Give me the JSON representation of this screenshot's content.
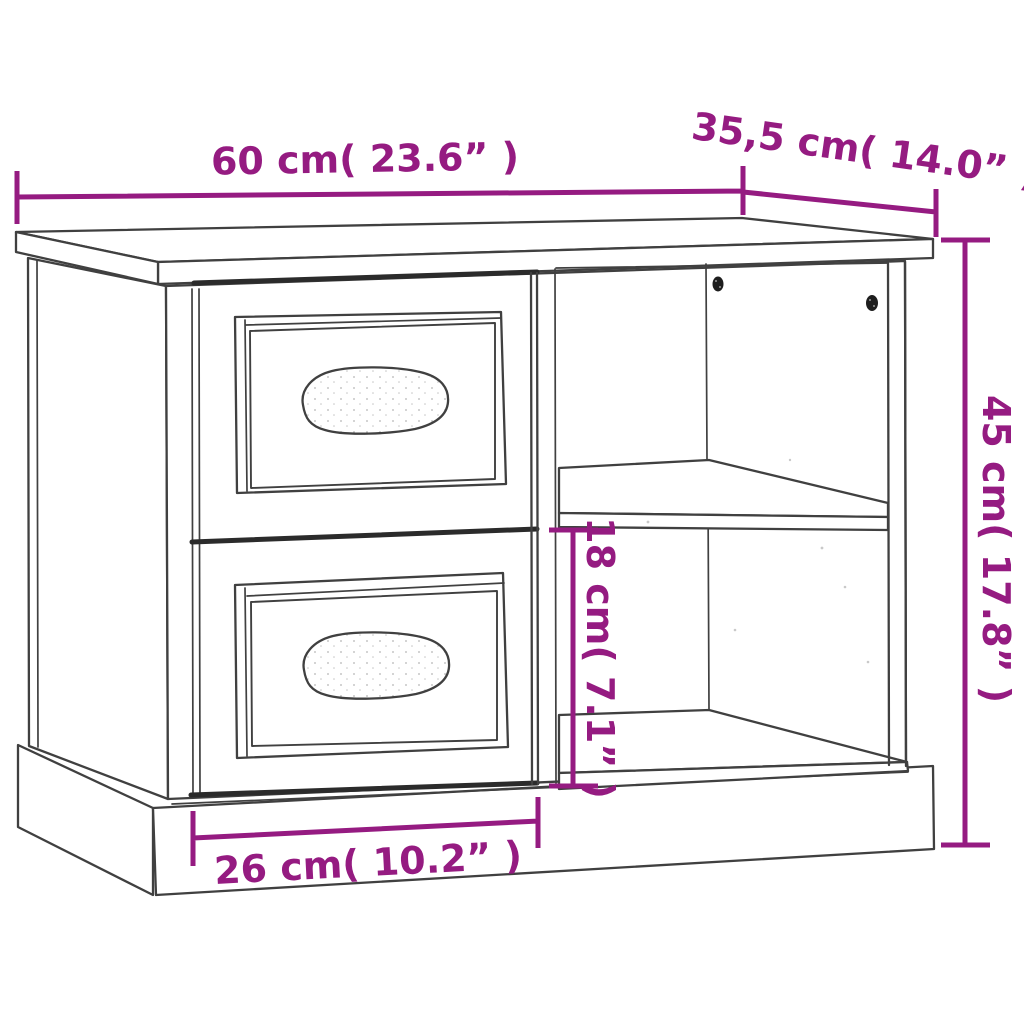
{
  "diagram": {
    "subject": "Bedside cabinet line drawing with two drawers, shell handles, open shelf compartments and plinth base",
    "style": "technical product dimension diagram"
  },
  "colors": {
    "purple": "#951b81",
    "ink": "#404040",
    "ink-strong": "#2b2b2b",
    "bg": "#ffffff"
  },
  "dimensions": {
    "width": {
      "metric": "60 cm",
      "imperial": "23.6”",
      "label": "60 cm( 23.6” )"
    },
    "depth": {
      "metric": "35,5 cm",
      "imperial": "14.0”",
      "label": "35,5 cm( 14.0” )"
    },
    "height": {
      "metric": "45 cm",
      "imperial": "17.8”",
      "label": "45 cm( 17.8” )"
    },
    "compartment_height": {
      "metric": "18 cm",
      "imperial": "7.1”",
      "label": "18 cm( 7.1” )"
    },
    "drawer_width": {
      "metric": "26 cm",
      "imperial": "10.2”",
      "label": "26 cm( 10.2” )"
    }
  }
}
